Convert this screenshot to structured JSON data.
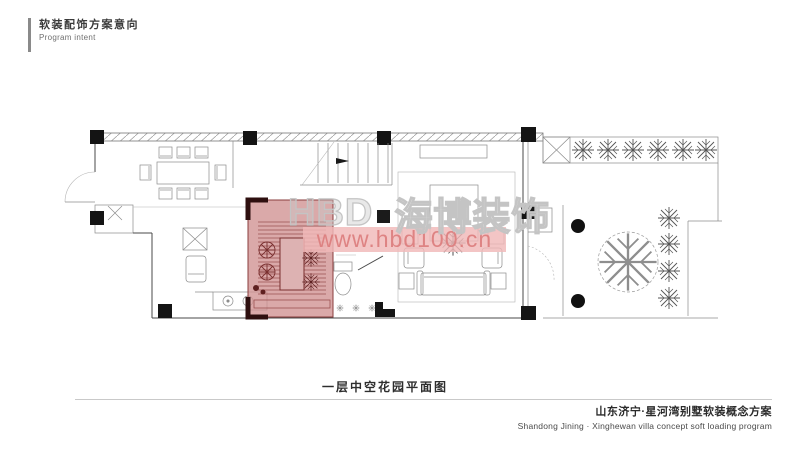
{
  "header": {
    "title_cn": "软装配饰方案意向",
    "title_en": "Program intent"
  },
  "watermark": {
    "brand_prefix": "HBD",
    "brand_cn": "海博装饰",
    "url": "www.hbd100.cn"
  },
  "plan": {
    "caption": "一层中空花园平面图",
    "highlighted_room": "中空花园"
  },
  "footer": {
    "project_cn": "山东济宁·星河湾别墅软装概念方案",
    "project_en": "Shandong Jining · Xinghewan villa concept soft loading program"
  },
  "colors": {
    "highlight_fill": "#cf9191",
    "highlight_line": "#8a3d3d",
    "highlight_dark": "#2e0f0f",
    "watermark_band": "#f0b8b8",
    "watermark_url_text": "#dc8080",
    "watermark_brand_stroke": "#c4c4c4",
    "plan_line": "#4a4a4a",
    "column": "#141414"
  }
}
